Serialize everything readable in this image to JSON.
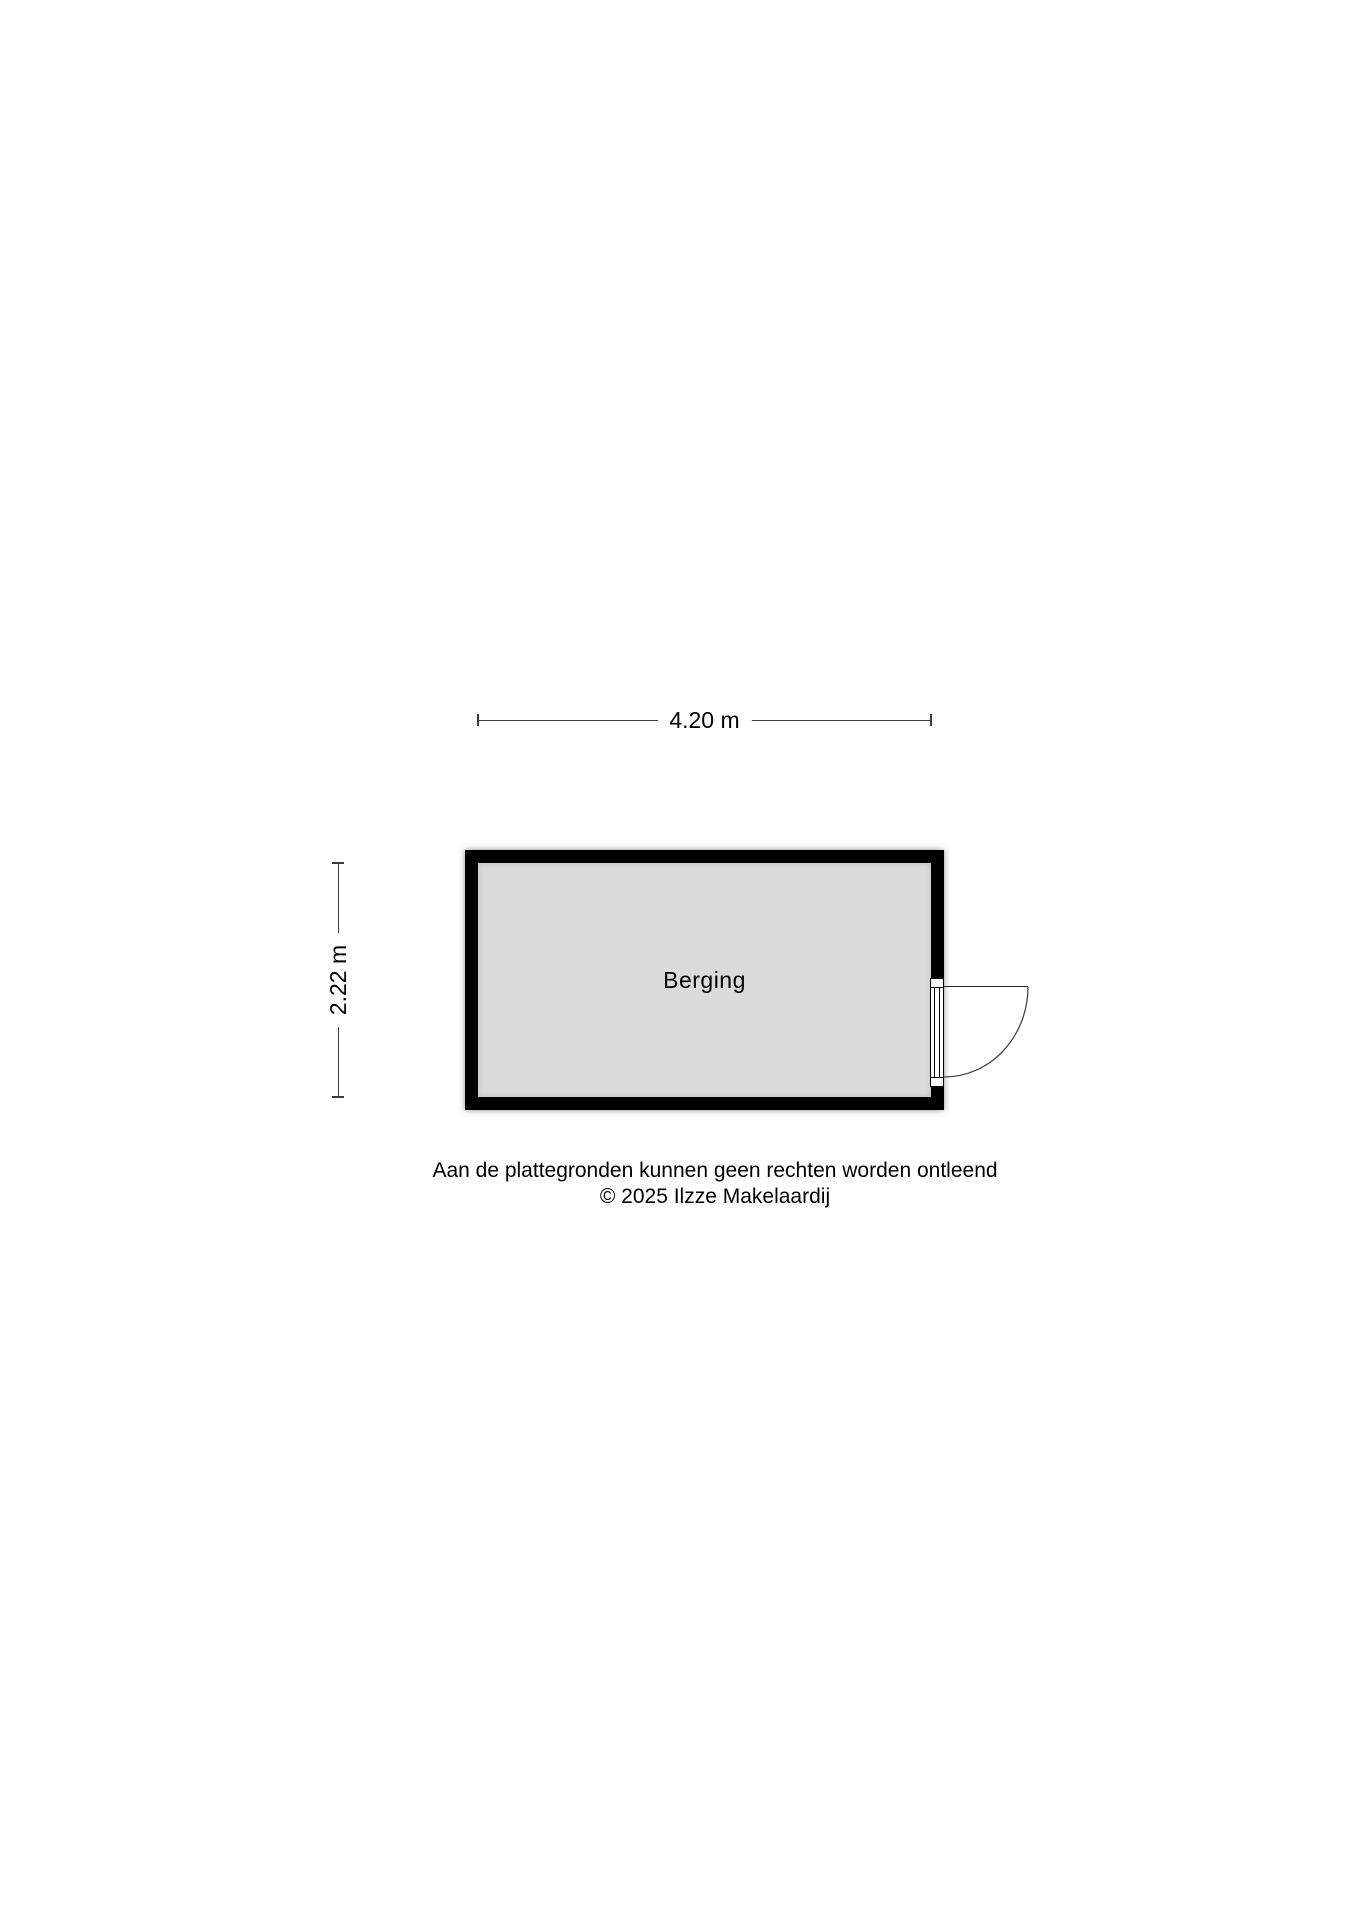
{
  "page": {
    "background": "#ffffff",
    "disclaimer": {
      "line1": "Aan de plattegronden kunnen geen rechten worden ontleend",
      "line2": "© 2025 Ilzze Makelaardij"
    }
  },
  "floorplan": {
    "room": {
      "label": "Berging",
      "fill_color": "#dbdbdb",
      "wall_color": "#000000"
    },
    "dimensions": {
      "width": "4.20 m",
      "height": "2.22 m"
    },
    "door": {
      "type": "single-swing-door",
      "wall": "right"
    }
  }
}
